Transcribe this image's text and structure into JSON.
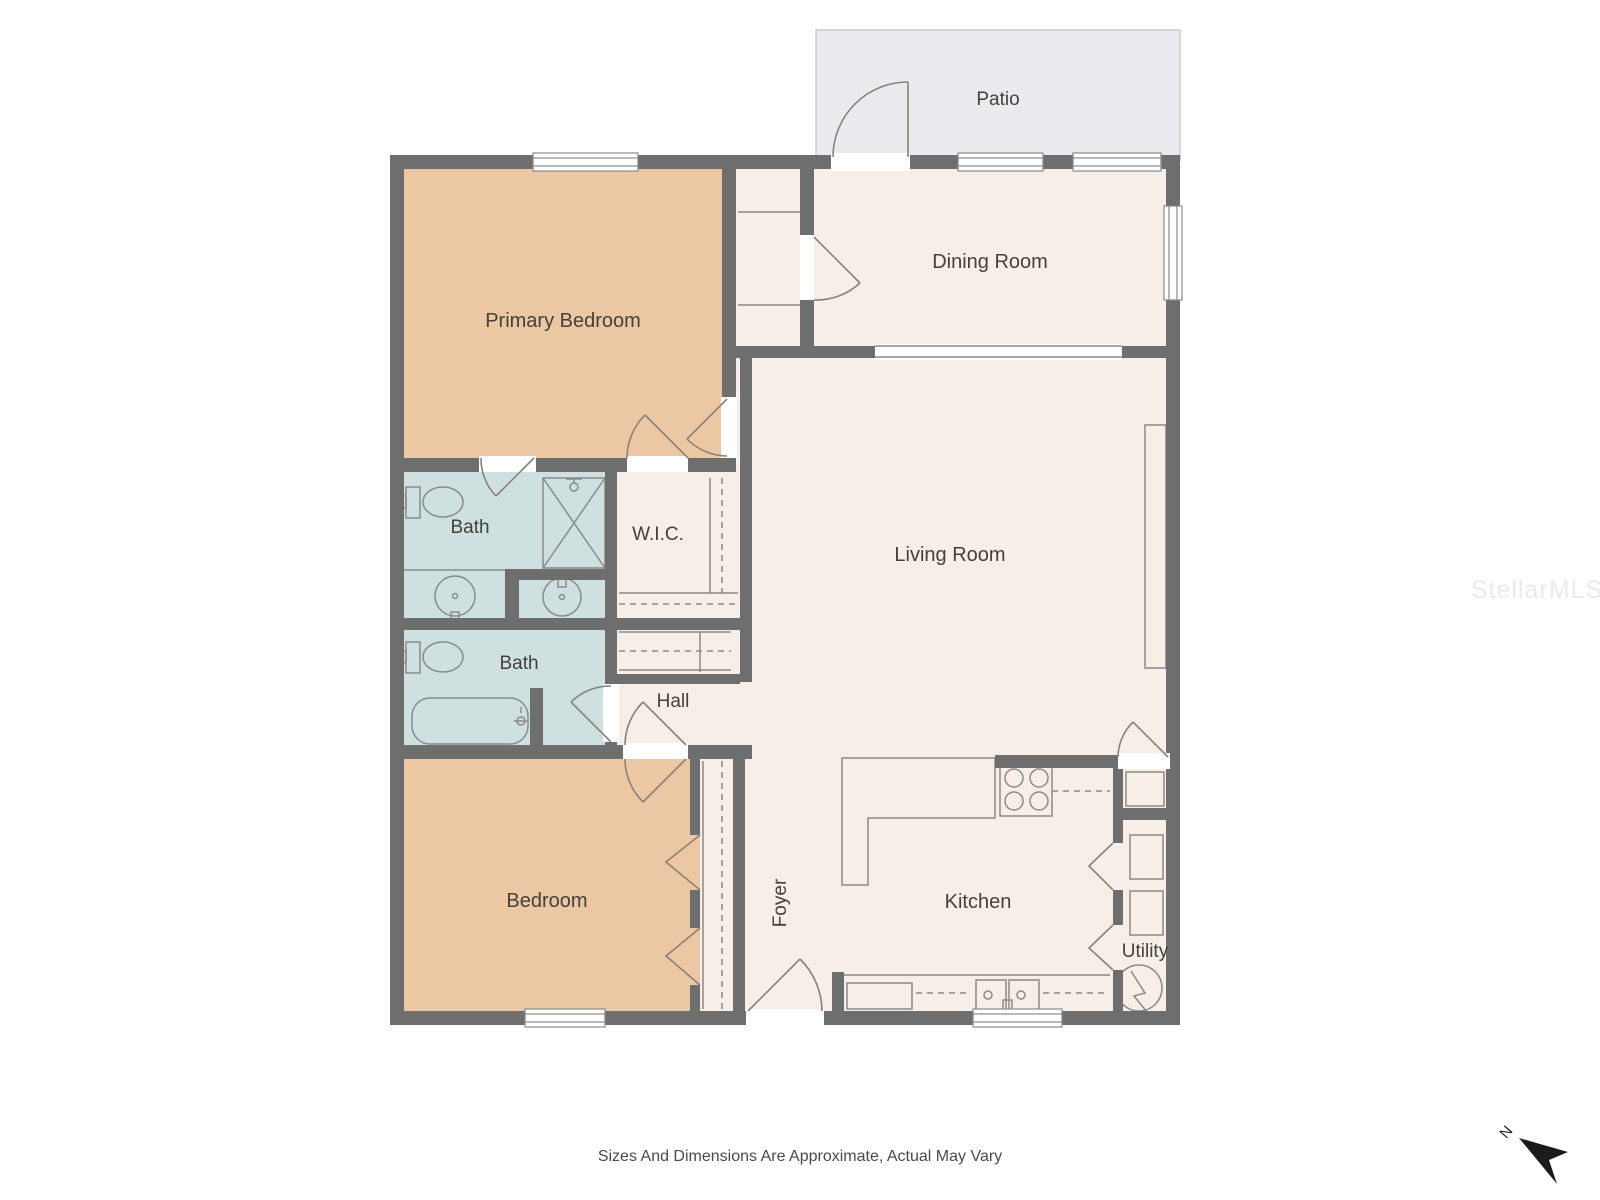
{
  "colors": {
    "wall": "#6e6e6e",
    "room": "#f6eee7",
    "bedroom": "#ebc7a3",
    "bath": "#cfe0e1",
    "patio": "#e9ebee",
    "patio-border": "#c8ccd2",
    "line": "#8a8a8a",
    "door": "#8a8178",
    "label": "#44403b",
    "caption": "#4a4a4a",
    "watermark": "#e9eaec",
    "north": "#1b1b1b"
  },
  "rooms": {
    "patio": {
      "label": "Patio"
    },
    "primary_bedroom": {
      "label": "Primary Bedroom"
    },
    "dining_room": {
      "label": "Dining Room"
    },
    "living_room": {
      "label": "Living Room"
    },
    "bath_primary": {
      "label": "Bath"
    },
    "wic": {
      "label": "W.I.C."
    },
    "bath_hall": {
      "label": "Bath"
    },
    "hall": {
      "label": "Hall"
    },
    "bedroom": {
      "label": "Bedroom"
    },
    "foyer": {
      "label": "Foyer"
    },
    "kitchen": {
      "label": "Kitchen"
    },
    "utility": {
      "label": "Utility"
    }
  },
  "footer": {
    "disclaimer": "Sizes And Dimensions Are Approximate, Actual May Vary"
  },
  "watermark": {
    "text": "StellarMLS"
  },
  "compass": {
    "label": "N"
  }
}
